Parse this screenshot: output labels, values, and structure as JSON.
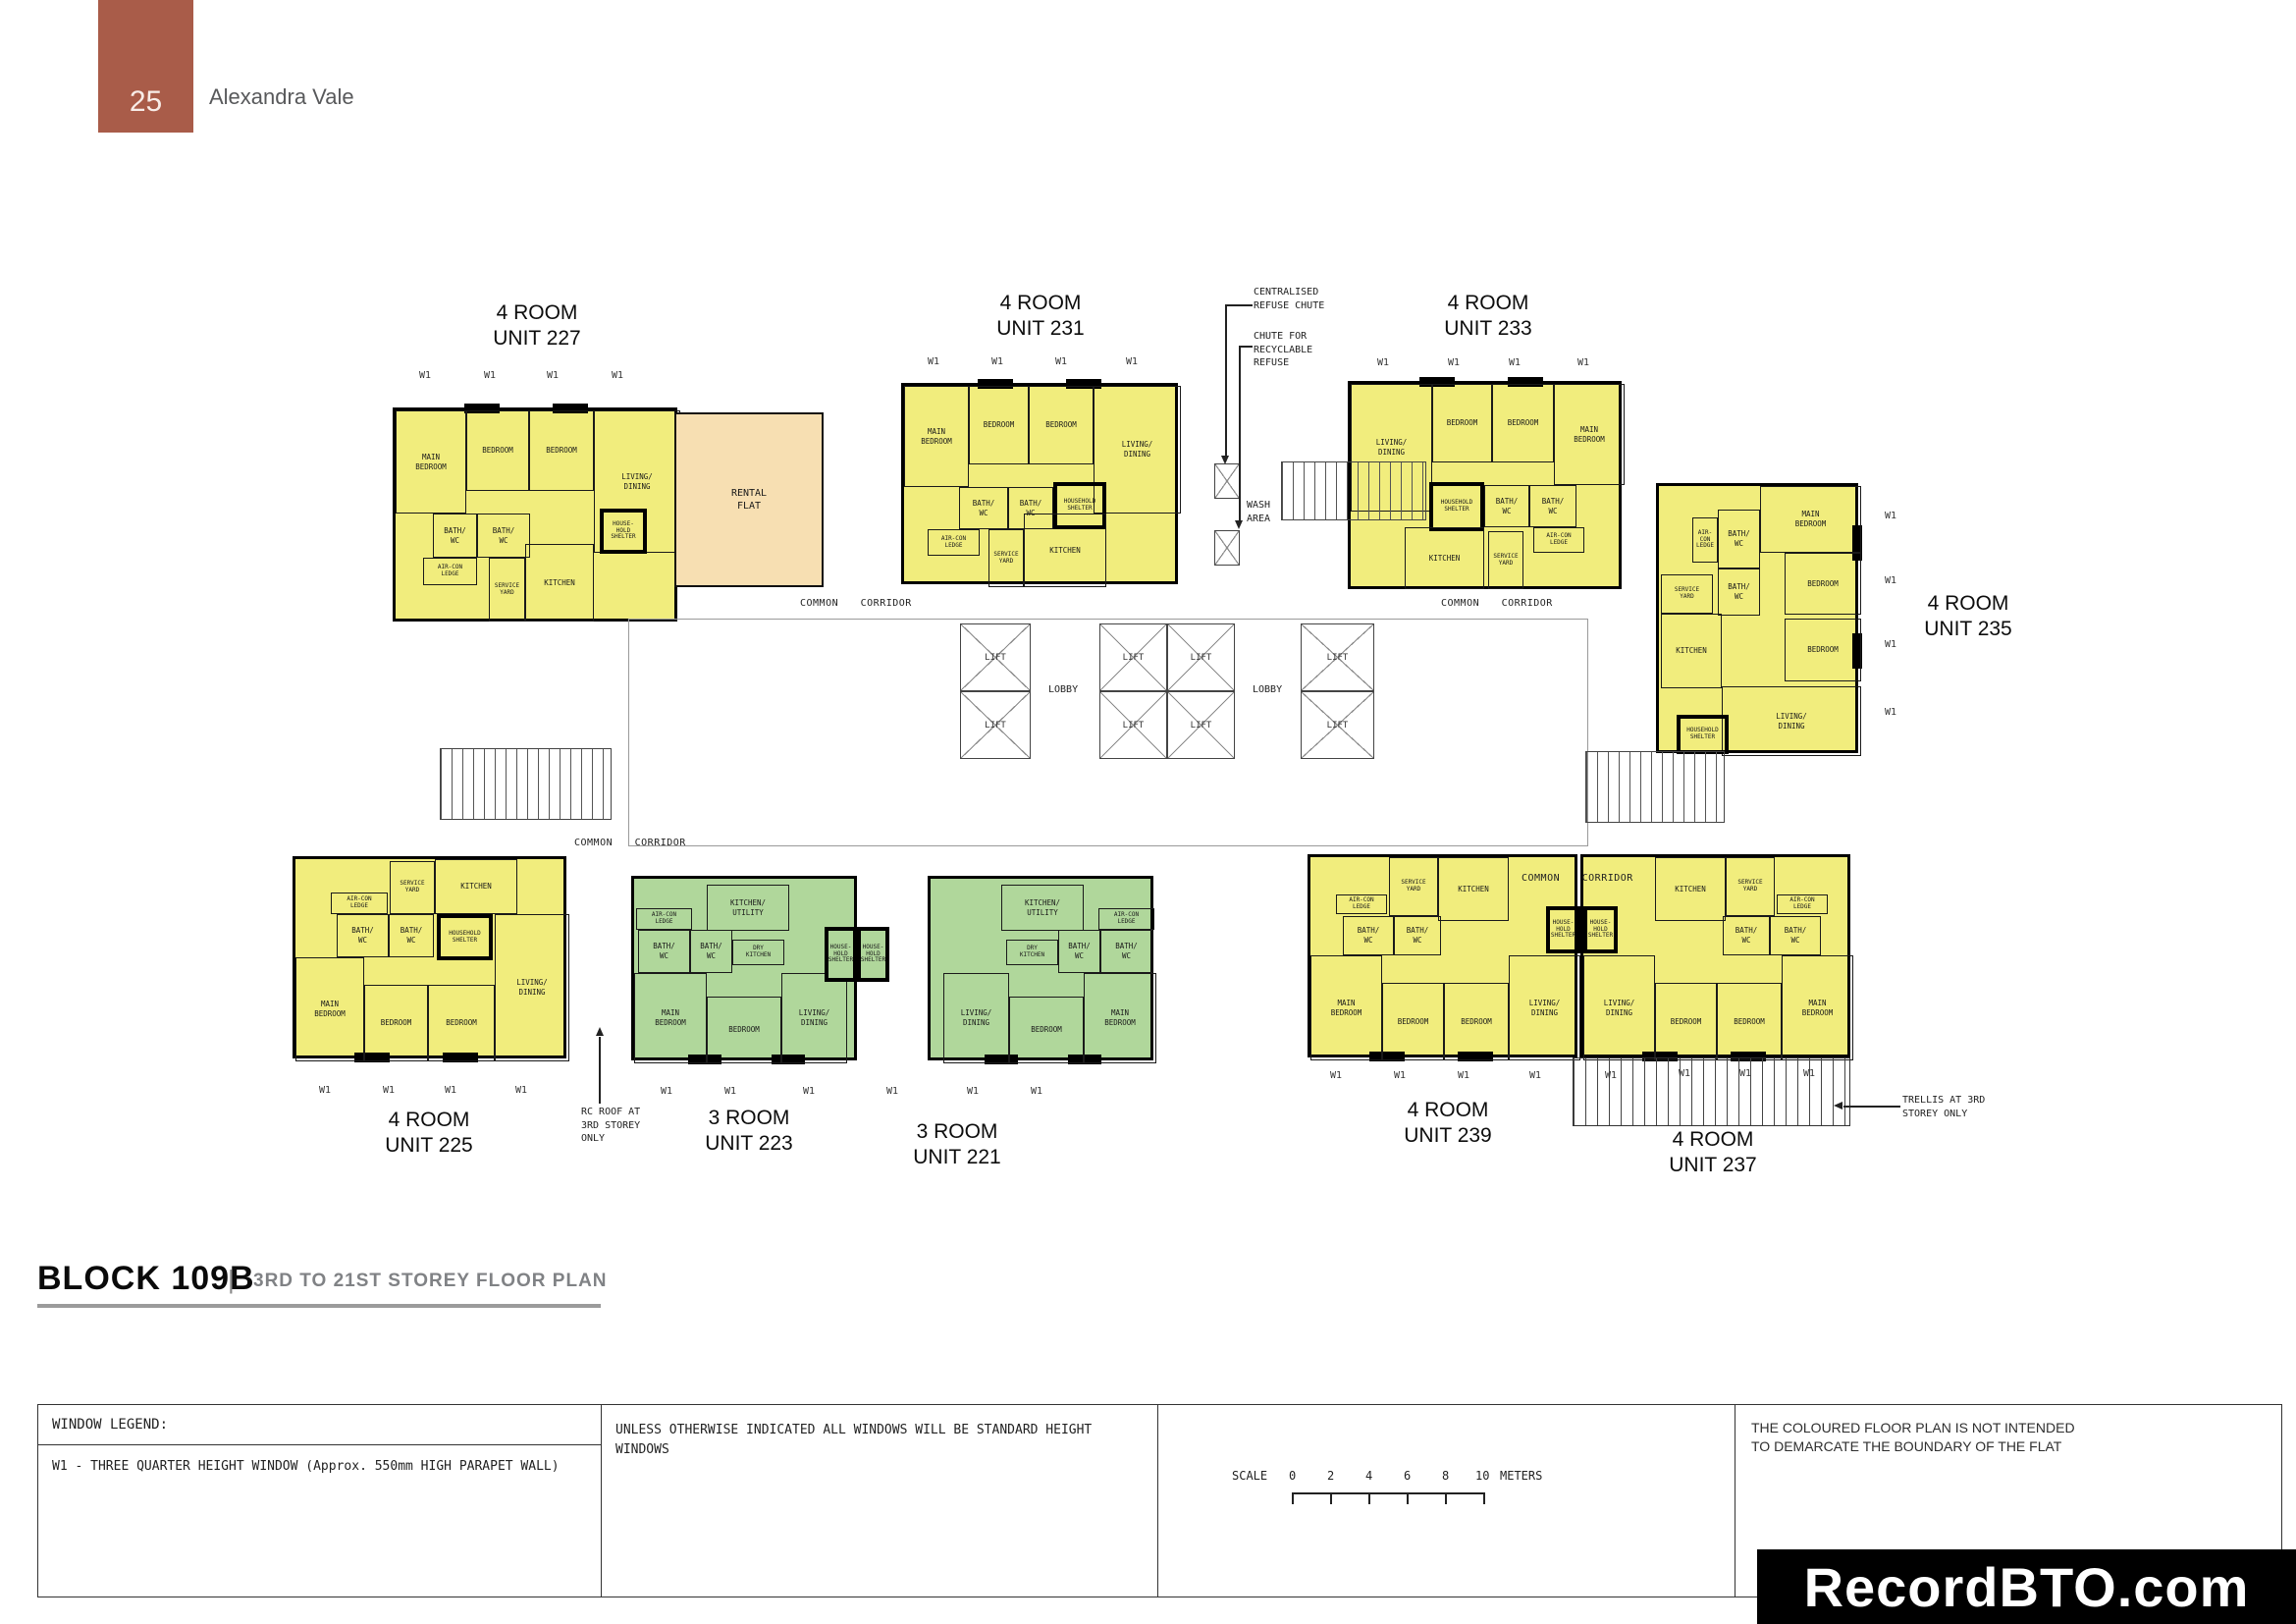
{
  "header": {
    "page_number": "25",
    "project_name": "Alexandra Vale"
  },
  "labels": {
    "lift": "LIFT",
    "lobby": "LOBBY",
    "common_corridor": "COMMON CORRIDOR",
    "wash_area": "WASH\nAREA",
    "rental_flat": "RENTAL\nFLAT",
    "w1": "W1"
  },
  "rooms": {
    "main_bedroom": "MAIN\nBEDROOM",
    "bedroom": "BEDROOM",
    "living_dining": "LIVING/\nDINING",
    "bath_wc": "BATH/\nWC",
    "kitchen": "KITCHEN",
    "kitchen_utility": "KITCHEN/\nUTILITY",
    "dry_kitchen": "DRY\nKITCHEN",
    "service_yard": "SERVICE\nYARD",
    "aircon_ledge": "AIR-CON\nLEDGE",
    "household_shelter": "HOUSEHOLD\nSHELTER",
    "household_shelter_small": "HOUSE-\nHOLD\nSHELTER"
  },
  "units": {
    "u227": {
      "type": "4 ROOM",
      "number": "UNIT 227"
    },
    "u231": {
      "type": "4 ROOM",
      "number": "UNIT 231"
    },
    "u233": {
      "type": "4 ROOM",
      "number": "UNIT 233"
    },
    "u235": {
      "type": "4 ROOM",
      "number": "UNIT 235"
    },
    "u225": {
      "type": "4 ROOM",
      "number": "UNIT 225"
    },
    "u223": {
      "type": "3 ROOM",
      "number": "UNIT 223"
    },
    "u221": {
      "type": "3 ROOM",
      "number": "UNIT 221"
    },
    "u239": {
      "type": "4 ROOM",
      "number": "UNIT 239"
    },
    "u237": {
      "type": "4 ROOM",
      "number": "UNIT 237"
    }
  },
  "annotations": {
    "centralised_refuse": "CENTRALISED\nREFUSE CHUTE",
    "recyclable_refuse": "CHUTE FOR\nRECYCLABLE\nREFUSE",
    "rc_roof": "RC ROOF AT\n3RD STOREY\nONLY",
    "trellis": "TRELLIS AT 3RD\nSTOREY ONLY"
  },
  "footer": {
    "block_title": "BLOCK 109B",
    "divider": "|",
    "plan_subtitle": "3RD TO 21ST STOREY FLOOR PLAN",
    "window_legend_title": "WINDOW LEGEND:",
    "w1_description": "W1 - THREE QUARTER HEIGHT WINDOW (Approx. 550mm HIGH PARAPET WALL)",
    "windows_note": "UNLESS OTHERWISE INDICATED ALL WINDOWS WILL BE STANDARD HEIGHT WINDOWS",
    "scale_label": "SCALE",
    "scale_ticks": [
      "0",
      "2",
      "4",
      "6",
      "8",
      "10"
    ],
    "scale_unit": "METERS",
    "disclaimer": "THE COLOURED FLOOR PLAN IS NOT INTENDED\nTO DEMARCATE THE BOUNDARY OF THE FLAT",
    "watermark": "RecordBTO.com"
  },
  "colors": {
    "accent": "#a95c49",
    "four_room": "#f1ed7d",
    "three_room": "#b0d79b",
    "rental": "#f7dfb2"
  }
}
